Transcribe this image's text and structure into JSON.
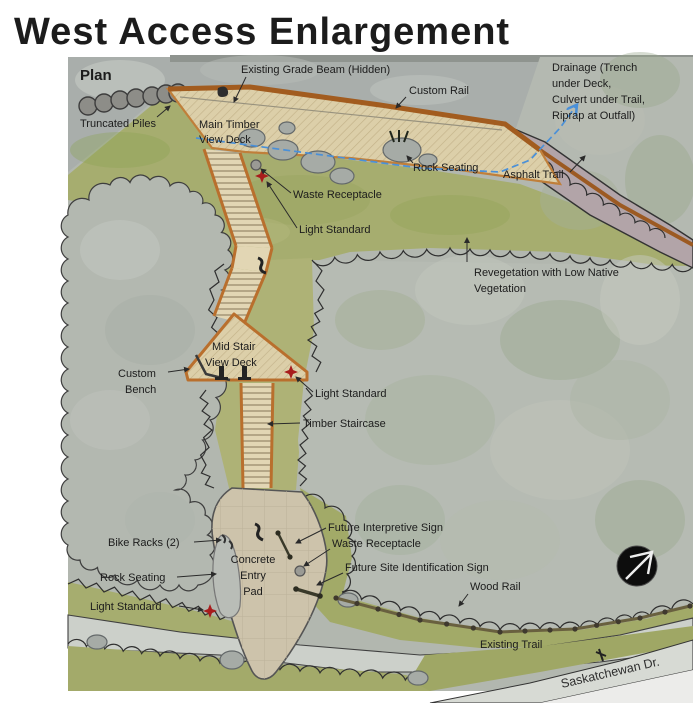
{
  "title": "West Access Enlargement",
  "plan": {
    "label": "Plan"
  },
  "colors": {
    "title_gold": "#d9ad29",
    "deck_fill": "#dccfa9",
    "deck_border": "#b96f2d",
    "rail_brown": "#a25c1f",
    "grass_green": "#a6ad6f",
    "tree_canopy_gray": "#b5bab2",
    "asphalt_trail_mauve": "#b2a4a8",
    "existing_trail_gray": "#ccd0ca",
    "concrete_pad_tan": "#cdc3ab",
    "drainage_blue": "#4a90d8",
    "light_standard_red": "#a81c1c",
    "label_black": "#1c1c1c"
  },
  "annotations": {
    "truncated_piles": "Truncated Piles",
    "existing_grade_beam": "Existing Grade Beam (Hidden)",
    "custom_rail": "Custom Rail",
    "drainage_l1": "Drainage (Trench",
    "drainage_l2": "under Deck,",
    "drainage_l3": "Culvert under Trail,",
    "drainage_l4": "Riprap at Outfall)",
    "main_timber_l1": "Main Timber",
    "main_timber_l2": "View Deck",
    "rock_seating_upper": "Rock Seating",
    "asphalt_trail": "Asphalt Trail",
    "waste_receptacle_upper": "Waste Receptacle",
    "light_standard_upper": "Light Standard",
    "revegetation_l1": "Revegetation with  Low Native",
    "revegetation_l2": "Vegetation",
    "custom_bench_l1": "Custom",
    "custom_bench_l2": "Bench",
    "mid_stair_l1": "Mid Stair",
    "mid_stair_l2": "View Deck",
    "light_standard_mid": "Light  Standard",
    "timber_staircase": "Timber Staircase",
    "bike_racks": "Bike Racks (2)",
    "concrete_pad_l1": "Concrete",
    "concrete_pad_l2": "Entry",
    "concrete_pad_l3": "Pad",
    "rock_seating_lower": "Rock Seating",
    "light_standard_lower": "Light  Standard",
    "future_interpretive_sign": "Future Interpretive Sign",
    "waste_receptacle_lower": "Waste Receptacle",
    "future_site_identification_sign": "Future Site Identification Sign",
    "wood_rail": "Wood Rail",
    "existing_trail": "Existing Trail",
    "saskatchewan_dr": "Saskatchewan Dr."
  }
}
